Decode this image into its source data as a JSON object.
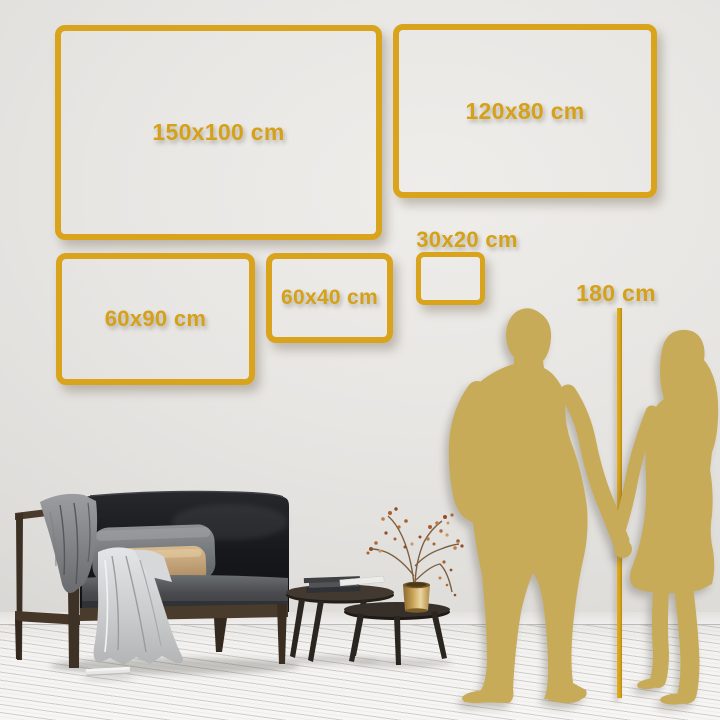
{
  "accent_color": "#D9A41C",
  "accent_text_color": "#D5A118",
  "silhouette_color": "#C8AB59",
  "sizes": [
    {
      "label": "150x100 cm"
    },
    {
      "label": "120x80 cm"
    },
    {
      "label": "60x90 cm"
    },
    {
      "label": "60x40 cm"
    },
    {
      "label": "30x20 cm"
    }
  ],
  "height_reference": {
    "label": "180 cm"
  },
  "scene": {
    "items": [
      "dark-sofa-with-gray-and-tan-pillows",
      "gray-blanket-on-armrest",
      "light-blanket-draped-to-floor",
      "book-on-floor",
      "two-round-coffee-tables-with-books",
      "brass-vase-with-dried-branches",
      "man-and-woman-gold-silhouette-holding-hands",
      "vertical-height-line"
    ]
  }
}
